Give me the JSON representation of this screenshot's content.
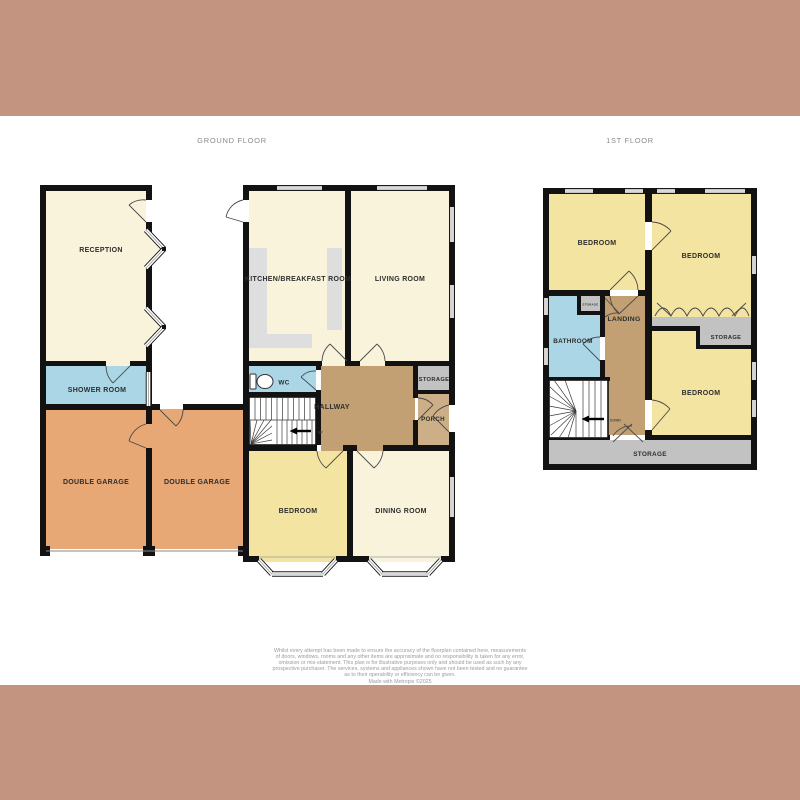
{
  "titles": {
    "ground": "GROUND FLOOR",
    "first": "1ST FLOOR"
  },
  "ground_floor": {
    "rooms": {
      "reception": "RECEPTION",
      "shower_room": "SHOWER ROOM",
      "double_garage_left": "DOUBLE GARAGE",
      "double_garage_right": "DOUBLE GARAGE",
      "kitchen_breakfast_room": "KITCHEN/BREAKFAST ROOM",
      "living_room": "LIVING ROOM",
      "wc": "WC",
      "hallway": "HALLWAY",
      "storage": "STORAGE",
      "porch": "PORCH",
      "bedroom": "BEDROOM",
      "dining_room": "DINING ROOM"
    },
    "stairs_direction": "UP"
  },
  "first_floor": {
    "rooms": {
      "bedroom_front": "BEDROOM",
      "bedroom_rear": "BEDROOM",
      "bedroom_side": "BEDROOM",
      "bathroom": "BATHROOM",
      "landing": "LANDING",
      "storage_small": "STORAGE",
      "storage_rear": "STORAGE",
      "storage_bottom": "STORAGE"
    },
    "stairs_direction": "DOWN"
  },
  "disclaimer": {
    "lines": [
      "Whilst every attempt has been made to ensure the accuracy of the floorplan contained here, measurements",
      "of doors, windows, rooms and any other items are approximate and no responsibility is taken for any error,",
      "omission or mis-statement. This plan is for illustrative purposes only and should be used as such by any",
      "prospective purchaser. The services, systems and appliances shown have not been tested and no guarantee",
      "as to their operability or efficiency can be given.",
      "Made with Metropix ©2025"
    ]
  },
  "colors": {
    "banner": "#c39480",
    "wall": "#121212",
    "cream_room": "#f8f3da",
    "yellow_room": "#f4e4a2",
    "blue_room": "#abd6e6",
    "orange_room": "#e7a876",
    "brown_room": "#c2a073",
    "porch_brown": "#cdaf87",
    "gray_storage": "#c2c2c2",
    "counter_gray": "#dedede"
  }
}
